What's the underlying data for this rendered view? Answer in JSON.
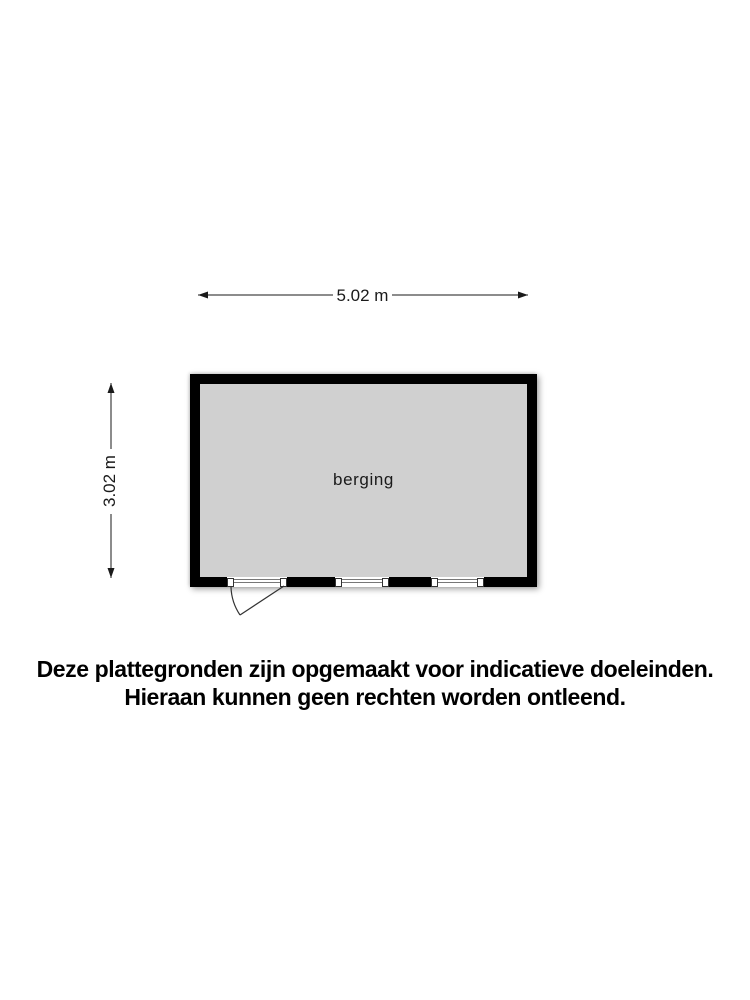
{
  "floorplan": {
    "room": {
      "label": "berging",
      "fill_color": "#d0d0d0",
      "wall_color": "#000000"
    },
    "dimensions": {
      "width": {
        "label": "5.02 m",
        "value_m": 5.02
      },
      "height": {
        "label": "3.02 m",
        "value_m": 3.02
      }
    }
  },
  "disclaimer": {
    "line1": "Deze plattegronden zijn opgemaakt voor indicatieve doeleinden.",
    "line2": "Hieraan kunnen geen rechten worden ontleend."
  }
}
